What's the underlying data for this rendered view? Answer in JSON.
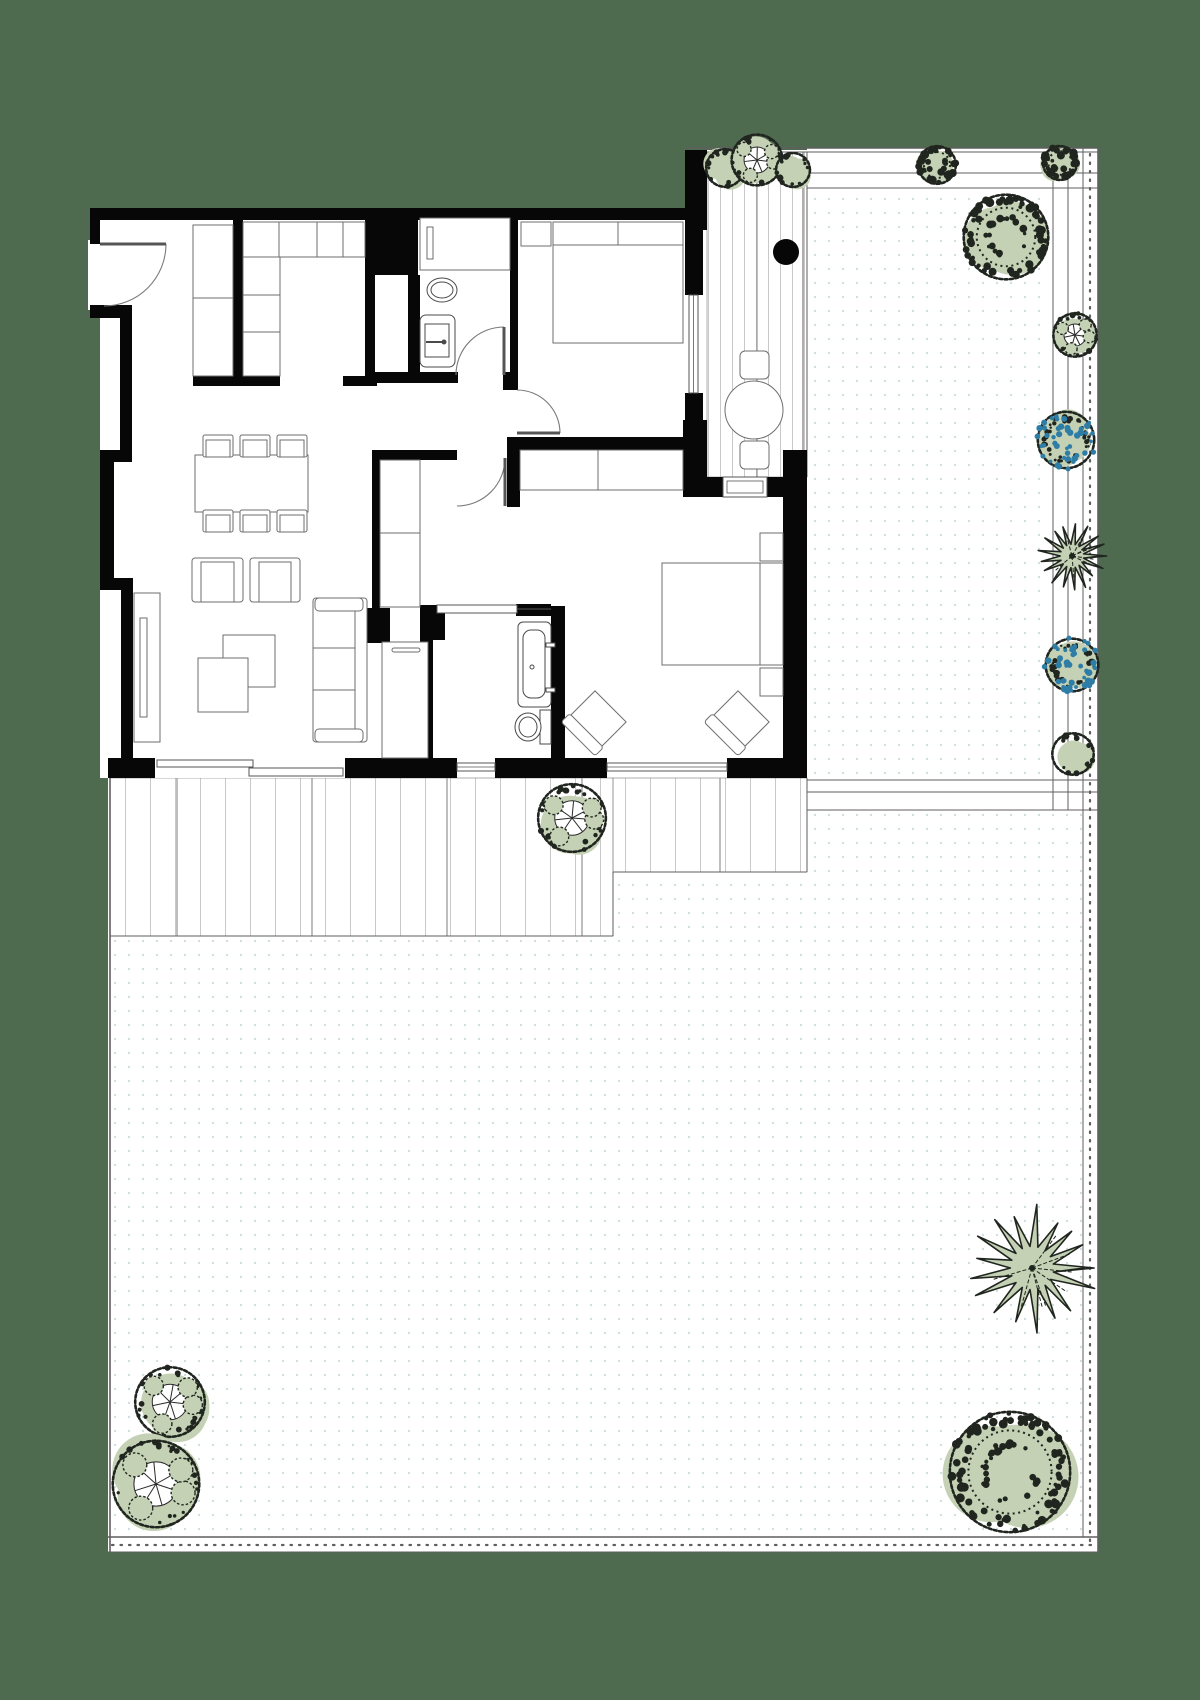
{
  "canvas": {
    "w": 1200,
    "h": 1700,
    "bg": "#4e6b50"
  },
  "palette": {
    "paper": "#ffffff",
    "wall": "#070707",
    "line": "#6a6a6a",
    "fence": "#5f5f5f",
    "deck_line": "#c9c9c9",
    "deck_divider": "#9a9a9a",
    "deck_edge": "#8a8a8a",
    "furniture": "#6e6e6e",
    "fixture": "#4a4a4a",
    "garden_dot": "#cfe0e1",
    "foliage": "#c4d1b4",
    "foliage_dark": "#20261f",
    "flower_blue": "#2e7da6",
    "door": "#555555",
    "arc": "#7a7a7a"
  },
  "paper": [
    [
      100,
      208,
      707,
      570
    ],
    [
      703,
      150,
      104,
      327
    ],
    [
      807,
      148,
      291,
      664
    ],
    [
      108,
      778,
      699,
      160
    ],
    [
      108,
      810,
      990,
      742
    ],
    [
      88,
      240,
      14,
      70
    ]
  ],
  "garden_dots": [
    [
      812,
      192,
      238,
      585
    ],
    [
      810,
      813,
      275,
      720
    ],
    [
      617,
      875,
      193,
      658
    ],
    [
      112,
      940,
      505,
      593
    ]
  ],
  "decks": [
    {
      "name": "deck-south-left",
      "x": 110,
      "y": 778,
      "w": 503,
      "h": 158,
      "plank": 25,
      "dividers": [
        177,
        312,
        447,
        582
      ]
    },
    {
      "name": "deck-south-right",
      "x": 613,
      "y": 778,
      "w": 194,
      "h": 94,
      "plank": 25,
      "dividers": [
        720
      ]
    },
    {
      "name": "deck-east",
      "x": 707,
      "y": 152,
      "w": 100,
      "h": 325,
      "plank": 12,
      "dividers": [
        757
      ]
    }
  ],
  "lines": [
    {
      "x1": 685,
      "y1": 148,
      "x2": 1098,
      "y2": 148,
      "w": 1.6
    },
    {
      "x1": 707,
      "y1": 152,
      "x2": 1098,
      "y2": 152,
      "w": 1
    },
    {
      "x1": 807,
      "y1": 173,
      "x2": 1098,
      "y2": 173,
      "w": 1
    },
    {
      "x1": 807,
      "y1": 188,
      "x2": 1098,
      "y2": 188,
      "w": 1
    },
    {
      "x1": 1053,
      "y1": 148,
      "x2": 1053,
      "y2": 810,
      "w": 1
    },
    {
      "x1": 1068,
      "y1": 148,
      "x2": 1068,
      "y2": 810,
      "w": 1
    },
    {
      "x1": 1083,
      "y1": 148,
      "x2": 1083,
      "y2": 1537,
      "w": 1
    },
    {
      "x1": 1090,
      "y1": 154,
      "x2": 1090,
      "y2": 1545,
      "w": 2.2,
      "dash": "1.5 7"
    },
    {
      "x1": 1098,
      "y1": 148,
      "x2": 1098,
      "y2": 1552,
      "w": 1.6
    },
    {
      "x1": 807,
      "y1": 780,
      "x2": 1098,
      "y2": 780,
      "w": 1
    },
    {
      "x1": 807,
      "y1": 792,
      "x2": 1098,
      "y2": 792,
      "w": 1
    },
    {
      "x1": 807,
      "y1": 810,
      "x2": 1098,
      "y2": 810,
      "w": 1
    },
    {
      "x1": 803,
      "y1": 152,
      "x2": 803,
      "y2": 477,
      "w": 1
    },
    {
      "x1": 807,
      "y1": 152,
      "x2": 807,
      "y2": 477,
      "w": 1
    },
    {
      "x1": 807,
      "y1": 778,
      "x2": 807,
      "y2": 872,
      "w": 1
    },
    {
      "x1": 613,
      "y1": 872,
      "x2": 613,
      "y2": 936,
      "w": 1
    },
    {
      "x1": 613,
      "y1": 872,
      "x2": 807,
      "y2": 872,
      "w": 1
    },
    {
      "x1": 110,
      "y1": 936,
      "x2": 613,
      "y2": 936,
      "w": 1
    },
    {
      "x1": 110,
      "y1": 778,
      "x2": 110,
      "y2": 1552,
      "w": 1.6
    },
    {
      "x1": 108,
      "y1": 1537,
      "x2": 1098,
      "y2": 1537,
      "w": 1.6
    },
    {
      "x1": 112,
      "y1": 1545,
      "x2": 1094,
      "y2": 1545,
      "w": 2.2,
      "dash": "1.5 7"
    },
    {
      "x1": 108,
      "y1": 1552,
      "x2": 1098,
      "y2": 1552,
      "w": 1
    },
    {
      "x1": 85,
      "y1": 206,
      "x2": 85,
      "y2": 318,
      "w": 1,
      "dash": "4 3"
    },
    {
      "x1": 85,
      "y1": 316,
      "x2": 120,
      "y2": 316,
      "w": 1,
      "dash": "4 3"
    }
  ],
  "walls": [
    [
      90,
      208,
      600,
      12
    ],
    [
      685,
      150,
      22,
      80
    ],
    [
      90,
      208,
      10,
      36
    ],
    [
      90,
      305,
      42,
      13
    ],
    [
      120,
      318,
      12,
      136
    ],
    [
      100,
      450,
      32,
      12
    ],
    [
      100,
      460,
      14,
      122
    ],
    [
      100,
      578,
      33,
      12
    ],
    [
      121,
      588,
      12,
      172
    ],
    [
      108,
      758,
      47,
      20
    ],
    [
      345,
      758,
      112,
      20
    ],
    [
      495,
      758,
      112,
      20
    ],
    [
      727,
      758,
      80,
      20
    ],
    [
      783,
      450,
      24,
      328
    ],
    [
      683,
      420,
      24,
      77
    ],
    [
      707,
      477,
      16,
      20
    ],
    [
      767,
      477,
      40,
      20
    ],
    [
      685,
      230,
      18,
      67
    ],
    [
      685,
      391,
      18,
      60
    ],
    [
      233,
      220,
      10,
      158
    ],
    [
      365,
      220,
      10,
      158
    ],
    [
      373,
      215,
      45,
      60
    ],
    [
      408,
      275,
      12,
      100
    ],
    [
      193,
      376,
      87,
      10
    ],
    [
      343,
      376,
      34,
      10
    ],
    [
      373,
      372,
      85,
      11
    ],
    [
      503,
      372,
      15,
      18
    ],
    [
      510,
      220,
      8,
      156
    ],
    [
      507,
      437,
      176,
      13
    ],
    [
      507,
      437,
      13,
      70
    ],
    [
      372,
      450,
      85,
      10
    ],
    [
      372,
      460,
      8,
      148
    ],
    [
      367,
      608,
      23,
      35
    ],
    [
      420,
      605,
      25,
      35
    ],
    [
      420,
      640,
      13,
      118
    ],
    [
      551,
      606,
      14,
      152
    ],
    [
      516,
      604,
      35,
      12
    ]
  ],
  "windows": [
    {
      "name": "living-sliding-door",
      "type": "slider",
      "x": 155,
      "y": 758,
      "w": 190,
      "h": 20,
      "panels": [
        [
          157,
          760,
          96,
          7
        ],
        [
          249,
          768,
          94,
          8
        ]
      ]
    },
    {
      "name": "bath-window",
      "type": "win-h",
      "x": 457,
      "y": 760,
      "w": 38
    },
    {
      "name": "bedroom2-window",
      "type": "win-h",
      "x": 607,
      "y": 760,
      "w": 120
    },
    {
      "name": "bedroom1-window",
      "type": "win-v",
      "x": 685,
      "y": 295,
      "h": 98
    },
    {
      "name": "deck-threshold",
      "type": "threshold",
      "x": 723,
      "y": 477,
      "w": 44,
      "h": 20
    },
    {
      "name": "bath-sliding-door",
      "type": "slider-panel",
      "x": 437,
      "y": 605,
      "w": 80,
      "h": 8
    }
  ],
  "doors": [
    {
      "name": "entry-door",
      "leaf": [
        100,
        244,
        166,
        244
      ],
      "arc": "M166,244 A62,62 0 0 1 104,306"
    },
    {
      "name": "wc-door",
      "leaf": [
        504,
        327,
        504,
        375
      ],
      "arc": "M504,327 A48,48 0 0 0 456,375"
    },
    {
      "name": "bedroom1-door",
      "leaf": [
        517,
        433,
        560,
        433
      ],
      "arc": "M517,390 A43,43 0 0 1 560,433"
    },
    {
      "name": "hall-door",
      "leaf": [
        505,
        458,
        505,
        506
      ],
      "arc": "M505,458 A48,48 0 0 1 457,506"
    }
  ],
  "furniture": [
    {
      "name": "entry-closet",
      "type": "cells",
      "x": 193,
      "y": 225,
      "w": 40,
      "h": 151,
      "sy": [
        298
      ]
    },
    {
      "name": "kitchen-counter-top",
      "type": "cells",
      "x": 243,
      "y": 222,
      "w": 122,
      "h": 35,
      "sx": [
        279,
        317,
        343
      ]
    },
    {
      "name": "kitchen-counter-side",
      "type": "cells",
      "x": 243,
      "y": 257,
      "w": 37,
      "h": 119,
      "sy": [
        295,
        332
      ]
    },
    {
      "name": "wc-counter",
      "type": "cells",
      "x": 420,
      "y": 218,
      "w": 90,
      "h": 52
    },
    {
      "name": "wc-radiator",
      "type": "rect",
      "x": 427,
      "y": 227,
      "w": 6,
      "h": 32
    },
    {
      "name": "wc-toilet",
      "type": "toilet",
      "cx": 442,
      "cy": 290,
      "rx": 15,
      "ry": 12
    },
    {
      "name": "wc-basin",
      "type": "basin",
      "x": 420,
      "y": 315,
      "w": 35,
      "h": 52
    },
    {
      "name": "bed1-nightstand",
      "type": "rect",
      "x": 521,
      "y": 222,
      "w": 30,
      "h": 24
    },
    {
      "name": "bed1",
      "type": "bed",
      "x": 553,
      "y": 222,
      "w": 130,
      "h": 121,
      "band": 23,
      "side": "top",
      "split": 618
    },
    {
      "name": "bed2-wardrobe",
      "type": "cells",
      "x": 520,
      "y": 450,
      "w": 163,
      "h": 40,
      "sx": [
        598
      ]
    },
    {
      "name": "bed2",
      "type": "bed",
      "x": 662,
      "y": 563,
      "w": 121,
      "h": 102,
      "band": 23,
      "side": "right"
    },
    {
      "name": "bed2-nightstand-a",
      "type": "rect",
      "x": 760,
      "y": 533,
      "w": 23,
      "h": 28
    },
    {
      "name": "bed2-nightstand-b",
      "type": "rect",
      "x": 760,
      "y": 668,
      "w": 23,
      "h": 28
    },
    {
      "name": "bed2-armchair-a",
      "type": "armchair-diag",
      "cx": 595,
      "cy": 722,
      "s": 44
    },
    {
      "name": "bed2-armchair-b",
      "type": "armchair-diag",
      "cx": 738,
      "cy": 722,
      "s": 44
    },
    {
      "name": "bath-tub",
      "type": "tub",
      "x": 518,
      "y": 622,
      "w": 33,
      "h": 85
    },
    {
      "name": "bath-toilet",
      "type": "toilet2",
      "cx": 528,
      "cy": 727,
      "rx": 13,
      "ry": 14,
      "tank": [
        540,
        710,
        11,
        34
      ]
    },
    {
      "name": "hall-closet",
      "type": "cells",
      "x": 380,
      "y": 460,
      "w": 40,
      "h": 147,
      "sy": [
        533
      ]
    },
    {
      "name": "hall-cabinet",
      "type": "cabinet",
      "x": 382,
      "y": 642,
      "w": 46,
      "h": 116,
      "handle": [
        392,
        648,
        28,
        4
      ]
    },
    {
      "name": "dining-table",
      "type": "rect",
      "x": 195,
      "y": 455,
      "w": 113,
      "h": 57
    },
    {
      "name": "dining-chair",
      "type": "chair",
      "x": 203,
      "y": 435,
      "w": 30,
      "h": 22
    },
    {
      "name": "dining-chair",
      "type": "chair",
      "x": 240,
      "y": 435,
      "w": 30,
      "h": 22
    },
    {
      "name": "dining-chair",
      "type": "chair",
      "x": 277,
      "y": 435,
      "w": 30,
      "h": 22
    },
    {
      "name": "dining-chair",
      "type": "chair",
      "x": 203,
      "y": 510,
      "w": 30,
      "h": 22
    },
    {
      "name": "dining-chair",
      "type": "chair",
      "x": 240,
      "y": 510,
      "w": 30,
      "h": 22
    },
    {
      "name": "dining-chair",
      "type": "chair",
      "x": 277,
      "y": 510,
      "w": 30,
      "h": 22
    },
    {
      "name": "lounge-chair-a",
      "type": "chair2",
      "x": 192,
      "y": 558,
      "w": 51,
      "h": 44
    },
    {
      "name": "lounge-chair-b",
      "type": "chair2",
      "x": 250,
      "y": 558,
      "w": 50,
      "h": 44
    },
    {
      "name": "tv-unit",
      "type": "tv",
      "x": 134,
      "y": 593,
      "w": 26,
      "h": 149
    },
    {
      "name": "coffee-table-a",
      "type": "rect",
      "x": 223,
      "y": 635,
      "w": 52,
      "h": 52
    },
    {
      "name": "coffee-table-b",
      "type": "rect",
      "x": 198,
      "y": 658,
      "w": 50,
      "h": 54
    },
    {
      "name": "sofa",
      "type": "sofa",
      "x": 313,
      "y": 598,
      "w": 54,
      "h": 144
    },
    {
      "name": "bistro-table",
      "type": "circle",
      "cx": 754,
      "cy": 410,
      "r": 29
    },
    {
      "name": "bistro-chair-a",
      "type": "rrect",
      "x": 740,
      "y": 351,
      "w": 29,
      "h": 28
    },
    {
      "name": "bistro-chair-b",
      "type": "rrect",
      "x": 740,
      "y": 441,
      "w": 29,
      "h": 28
    },
    {
      "name": "planter-dot",
      "type": "dot",
      "cx": 786,
      "cy": 252,
      "r": 13
    }
  ],
  "plants": [
    {
      "name": "deck-shrub-a",
      "type": "bush",
      "cx": 725,
      "cy": 168,
      "r": 20
    },
    {
      "name": "deck-shrub-b",
      "type": "pinwheel",
      "cx": 757,
      "cy": 160,
      "r": 27
    },
    {
      "name": "deck-shrub-c",
      "type": "bush",
      "cx": 793,
      "cy": 170,
      "r": 18
    },
    {
      "name": "fence-shrub",
      "type": "bushdark",
      "cx": 937,
      "cy": 165,
      "r": 20
    },
    {
      "name": "corner-shrub",
      "type": "bushdark",
      "cx": 1060,
      "cy": 163,
      "r": 18
    },
    {
      "name": "big-tree",
      "type": "bushdark",
      "cx": 1006,
      "cy": 237,
      "r": 45
    },
    {
      "name": "border-pinwheel",
      "type": "pinwheel",
      "cx": 1075,
      "cy": 335,
      "r": 23
    },
    {
      "name": "border-flowers-a",
      "type": "flowers",
      "cx": 1066,
      "cy": 440,
      "r": 30
    },
    {
      "name": "border-palm",
      "type": "palm",
      "cx": 1072,
      "cy": 556,
      "r": 31
    },
    {
      "name": "border-flowers-b",
      "type": "flowers",
      "cx": 1072,
      "cy": 665,
      "r": 28
    },
    {
      "name": "border-shrub",
      "type": "bush",
      "cx": 1073,
      "cy": 754,
      "r": 22
    },
    {
      "name": "deck-tree",
      "type": "pinwheel",
      "cx": 572,
      "cy": 818,
      "r": 36
    },
    {
      "name": "garden-tree-sw-a",
      "type": "pinwheel",
      "cx": 170,
      "cy": 1402,
      "r": 37
    },
    {
      "name": "garden-tree-sw-b",
      "type": "pinwheel",
      "cx": 156,
      "cy": 1484,
      "r": 46
    },
    {
      "name": "garden-palm-se",
      "type": "palm",
      "cx": 1032,
      "cy": 1268,
      "r": 57
    },
    {
      "name": "garden-tree-se",
      "type": "bushdark",
      "cx": 1010,
      "cy": 1472,
      "r": 64
    }
  ]
}
